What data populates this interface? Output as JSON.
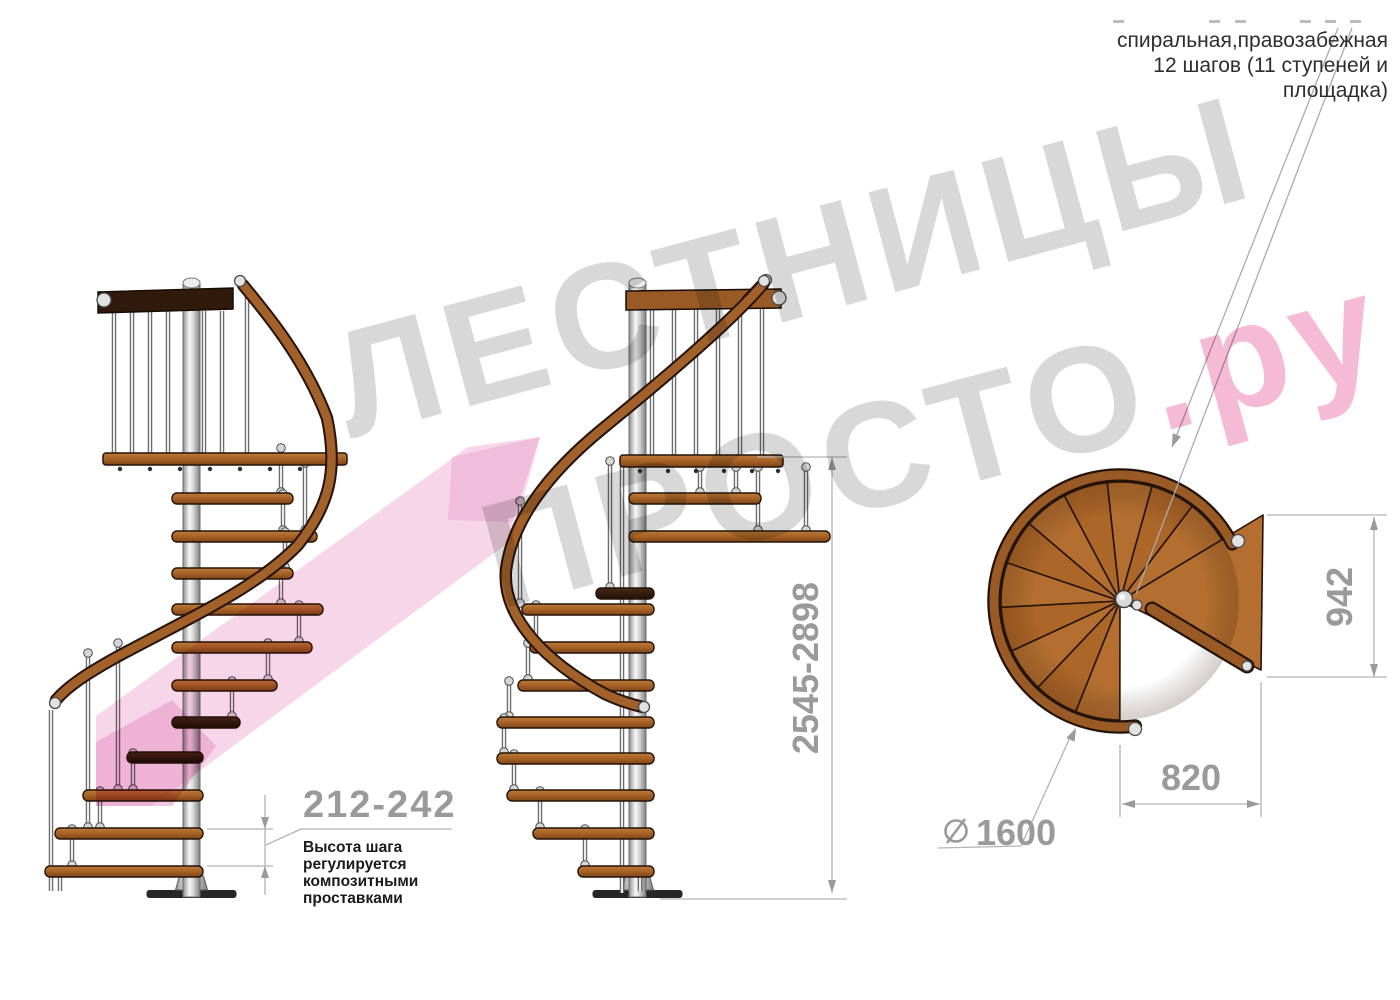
{
  "header": {
    "line1": "спиральная,правозабежная",
    "line2": "12 шагов (11 ступеней и",
    "line3": "площадка)"
  },
  "watermark": {
    "line1": "ЛЕСТНИЦЫ",
    "line2_gray": "ПРОСТО",
    "line2_pink": ".ру"
  },
  "note": {
    "dim": "212-242",
    "lines": [
      "Высота шага",
      "регулируется",
      "композитными",
      "проставками"
    ]
  },
  "dimensions": {
    "height_range": "2545-2898",
    "plan_width": "942",
    "plan_depth": "820",
    "diameter": "1600"
  },
  "colors": {
    "wood": "#a2602a",
    "wood_light": "#b46f30",
    "wood_outline": "#241309",
    "dark_rail": "#2f1a0c",
    "metal": "#d9d9d9",
    "dim_gray": "#9a9a9a",
    "watermark_gray": "#d8d8d8",
    "watermark_pink": "#f5bad6",
    "ribbon_pink": "#efaed4"
  },
  "drawing": {
    "views": [
      {
        "id": "left",
        "pole": {
          "cx": 191.5,
          "top": 277,
          "bottom": 897
        },
        "platform": {
          "x1": 103,
          "x2": 347,
          "y": 453,
          "bolts": [
            120,
            150,
            180,
            210,
            240,
            270,
            300,
            330
          ]
        },
        "railing": {
          "pts": "98,292 233,288 233,309 98,313",
          "color": "#2f1a0c",
          "cap": [
            104,
            300
          ],
          "balusters": [
            114,
            132,
            150,
            168,
            204,
            222
          ],
          "by1": 311,
          "by2": 453
        },
        "handrail": {
          "d": "M243 285 C268 315 305 360 327 418 C338 470 330 505 298 545 C255 590 175 625 115 658 C88 673 68 686 56 700",
          "start": [
            240,
            281
          ],
          "end": [
            55,
            703
          ]
        },
        "rods": [
          [
            281,
            447,
            493,
            1
          ],
          [
            305,
            462,
            531,
            1
          ],
          [
            283,
            493,
            531,
            1
          ],
          [
            285,
            531,
            568,
            1
          ],
          [
            281,
            568,
            604,
            1
          ],
          [
            299,
            604,
            642,
            1
          ],
          [
            268,
            642,
            680,
            1
          ],
          [
            232,
            680,
            717,
            1
          ],
          [
            133,
            752,
            790,
            1
          ],
          [
            100,
            790,
            828,
            1
          ],
          [
            72,
            828,
            866,
            1
          ],
          [
            60,
            866,
            891,
            0
          ],
          [
            247,
            293,
            453,
            0
          ],
          [
            51,
            710,
            891,
            0
          ],
          [
            88,
            652,
            828,
            1
          ],
          [
            118,
            642,
            790,
            1
          ]
        ],
        "steps": [
          [
            493,
            172,
            293,
            0
          ],
          [
            531,
            172,
            317,
            0
          ],
          [
            568,
            172,
            293,
            0
          ],
          [
            604,
            172,
            323,
            0
          ],
          [
            642,
            172,
            312,
            0
          ],
          [
            680,
            172,
            277,
            0
          ],
          [
            717,
            172,
            240,
            1
          ],
          [
            752,
            127,
            203,
            1
          ],
          [
            790,
            83,
            203,
            0
          ],
          [
            828,
            55,
            203,
            0
          ],
          [
            866,
            45,
            203,
            0
          ]
        ]
      },
      {
        "id": "mid",
        "pole": {
          "cx": 637.5,
          "top": 277,
          "bottom": 897
        },
        "platform": {
          "x1": 620,
          "x2": 783,
          "y": 455,
          "bolts": [
            640,
            668,
            696,
            724,
            752,
            778
          ]
        },
        "railing": {
          "pts": "626,291 781,289 781,308 626,310",
          "color": "#9a5a26",
          "cap": [
            779,
            298
          ],
          "balusters": [
            652,
            674,
            696,
            718,
            740,
            762
          ],
          "by1": 308,
          "by2": 455,
          "stub": {
            "x1": 747,
            "y1": 300,
            "x2": 765,
            "y2": 281,
            "cap": [
              766,
              280
            ]
          }
        },
        "handrail": {
          "d": "M764 283 C735 318 672 372 601 430 C550 472 512 520 506 570 C502 618 546 662 605 694 C622 702 634 705 643 707",
          "start": [
            764,
            281
          ],
          "end": [
            644,
            707
          ]
        },
        "rods": [
          [
            700,
            466,
            493,
            1
          ],
          [
            736,
            466,
            493,
            1
          ],
          [
            758,
            466,
            531,
            1
          ],
          [
            806,
            466,
            531,
            1
          ],
          [
            536,
            604,
            642,
            1
          ],
          [
            528,
            642,
            680,
            1
          ],
          [
            509,
            680,
            717,
            1
          ],
          [
            504,
            717,
            753,
            1
          ],
          [
            514,
            753,
            790,
            1
          ],
          [
            540,
            790,
            828,
            1
          ],
          [
            585,
            828,
            866,
            1
          ],
          [
            640,
            866,
            891,
            0
          ],
          [
            520,
            500,
            604,
            1
          ],
          [
            610,
            460,
            588,
            1
          ],
          [
            622,
            466,
            893,
            0
          ]
        ],
        "steps": [
          [
            493,
            629,
            761,
            0
          ],
          [
            531,
            629,
            830,
            0
          ],
          [
            588,
            596,
            654,
            1
          ],
          [
            604,
            522,
            654,
            0
          ],
          [
            642,
            530,
            654,
            0
          ],
          [
            680,
            518,
            654,
            0
          ],
          [
            717,
            497,
            654,
            0
          ],
          [
            753,
            497,
            654,
            0
          ],
          [
            790,
            507,
            654,
            0
          ],
          [
            828,
            533,
            654,
            0
          ],
          [
            866,
            578,
            654,
            0
          ]
        ]
      }
    ],
    "plan": {
      "cx": 1120,
      "cy": 601,
      "r": 119,
      "startAngle": -31,
      "stepAngle": -21.72,
      "nSteps": 11,
      "rim": {
        "r": 126,
        "a1": -27,
        "a2": -277,
        "caps": [
          [
            1238,
            541
          ],
          [
            1135,
            729
          ]
        ]
      },
      "landing": "1120,601 1263,515 1261,670",
      "rail": {
        "x1": 1152,
        "y1": 609,
        "x2": 1247,
        "y2": 666,
        "caps": [
          [
            1247,
            666
          ],
          [
            1137,
            605
          ]
        ]
      },
      "hub": [
        1124,
        599
      ]
    }
  }
}
